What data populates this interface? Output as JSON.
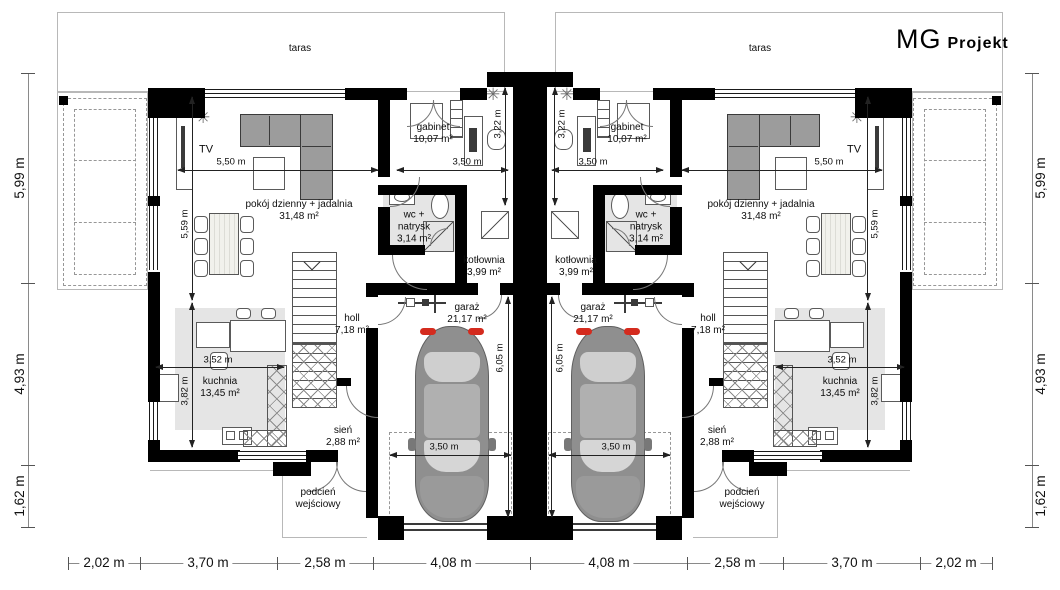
{
  "logo": {
    "mg": "MG",
    "projekt": "Projekt"
  },
  "rooms": {
    "taras": "taras",
    "tv": "TV",
    "gabinet": {
      "name": "gabinet",
      "area": "10,07 m²"
    },
    "pokoj": {
      "name": "pokój dzienny + jadalnia",
      "area": "31,48 m²"
    },
    "wc": {
      "line1": "wc +",
      "line2": "natrysk",
      "area": "3,14 m²"
    },
    "kotlownia": {
      "name": "kotłownia",
      "area": "3,99 m²"
    },
    "holl": {
      "name": "holl",
      "area": "7,18 m²"
    },
    "garaz": {
      "name": "garaż",
      "area": "21,17 m²"
    },
    "kuchnia": {
      "name": "kuchnia",
      "area": "13,45 m²"
    },
    "sien": {
      "name": "sień",
      "area": "2,88 m²"
    },
    "podcien": {
      "line1": "podcień",
      "line2": "wejściowy"
    }
  },
  "dims": {
    "living_width": "5,50 m",
    "gabinet_width": "3,50 m",
    "gabinet_depth": "3,22 m",
    "living_depth": "5,59 m",
    "kitchen_width": "3,52 m",
    "kitchen_depth": "3,82 m",
    "garage_depth": "6,05 m",
    "garage_width": "3,50 m",
    "side": [
      "5,99 m",
      "4,93 m",
      "1,62 m"
    ],
    "bottom": [
      "2,02 m",
      "3,70 m",
      "2,58 m",
      "4,08 m",
      "4,08 m",
      "2,58 m",
      "3,70 m",
      "2,02 m"
    ]
  },
  "icons": {
    "heater_star": "✳"
  },
  "colors": {
    "wall": "#000000",
    "room_fill": "#e5e5e5",
    "accent_red": "#d42b1e",
    "car_body": "#8f8f8f"
  }
}
